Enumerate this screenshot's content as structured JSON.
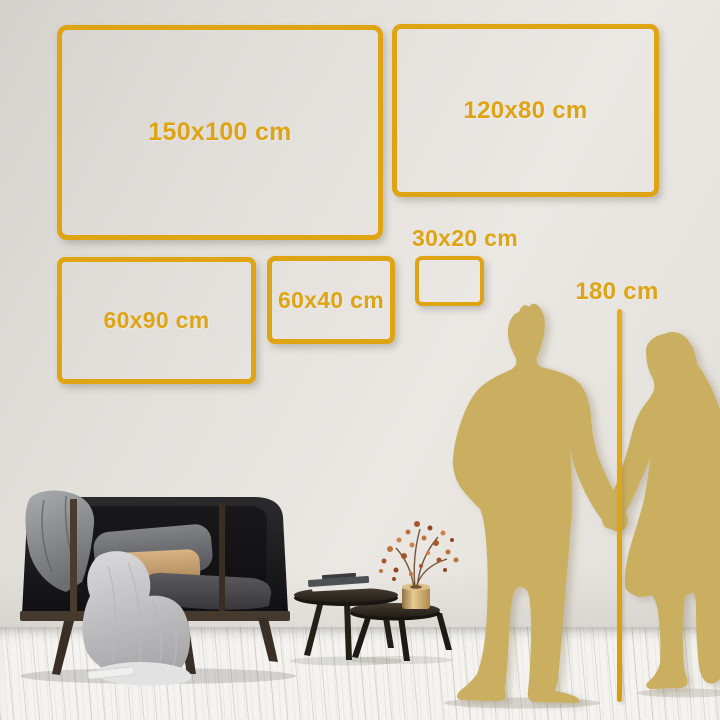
{
  "size_guide": {
    "frames": [
      {
        "id": "150x100",
        "label": "150x100 cm"
      },
      {
        "id": "120x80",
        "label": "120x80 cm"
      },
      {
        "id": "60x90",
        "label": "60x90 cm"
      },
      {
        "id": "60x40",
        "label": "60x40 cm"
      },
      {
        "id": "30x20",
        "label": "30x20 cm"
      }
    ],
    "height_reference": {
      "label": "180 cm"
    }
  },
  "colors": {
    "accent_gold": "#DFA413",
    "silhouette_gold": "#C9AF5E"
  },
  "scene": {
    "objects": [
      "sofa",
      "gray-throw",
      "light-throw",
      "cushions",
      "nesting-coffee-tables",
      "books",
      "brass-vase",
      "dried-branch",
      "man-silhouette",
      "woman-silhouette",
      "height-line"
    ]
  }
}
